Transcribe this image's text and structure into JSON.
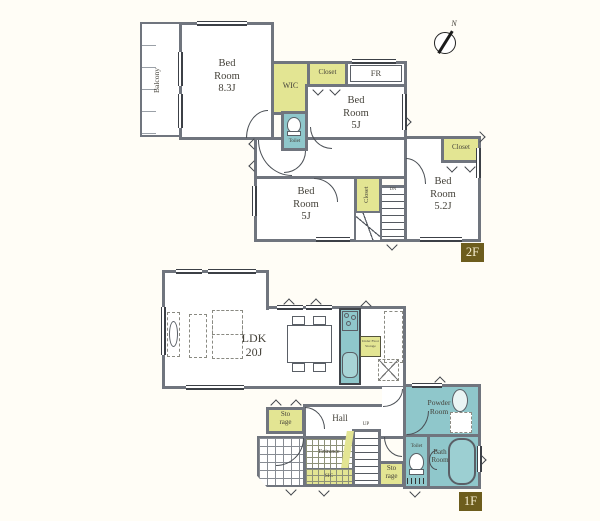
{
  "compass": {
    "north_label": "N"
  },
  "colors": {
    "wall": "#70757e",
    "closet_fill": "#e3e593",
    "wet_area_fill": "#8fc7cb",
    "badge_bg": "#6d5d1d",
    "badge_text": "#f6efd2",
    "label_text": "#45423a"
  },
  "floor2": {
    "badge": "2F",
    "balcony": "Balcony",
    "bedroom_main": {
      "name": "Bed Room",
      "size": "8.3J"
    },
    "wic": "WIC",
    "toilet": "Toilet",
    "closet_top": "Closet",
    "fr": "FR",
    "bedroom_ne": {
      "name": "Bed Room",
      "size": "5J"
    },
    "bedroom_sw": {
      "name": "Bed Room",
      "size": "5J"
    },
    "closet_mid": "Closet",
    "stairs_label": "DN",
    "bedroom_se": {
      "name": "Bed Room",
      "size": "5.2J"
    },
    "closet_se": "Closet"
  },
  "floor1": {
    "badge": "1F",
    "ldk": {
      "name": "LDK",
      "size": "20J"
    },
    "under_floor_storage": "Under Floor Storage",
    "storage_west": {
      "line1": "Sto",
      "line2": "rage"
    },
    "hall": "Hall",
    "entrance": "Entrance",
    "sic": "SIC",
    "stairs_label": "UP",
    "storage_mid": {
      "line1": "Sto",
      "line2": "rage"
    },
    "powder_room": {
      "line1": "Powder",
      "line2": "Room"
    },
    "toilet": "Toilet",
    "bath_room": {
      "line1": "Bath",
      "line2": "Room"
    }
  }
}
